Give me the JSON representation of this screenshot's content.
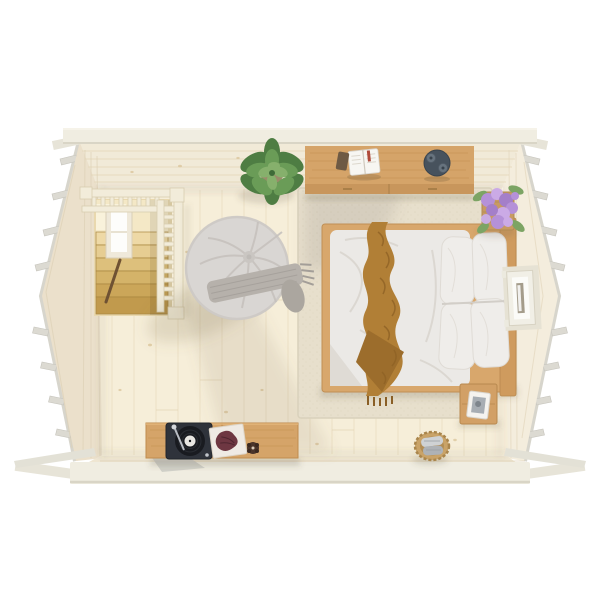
{
  "scene": {
    "title": "Top-down 3D render of a log cabin bedroom interior"
  },
  "labels": {
    "building": "Log cabin shell with protruding corner log ends",
    "floor": "Pale wooden plank floor",
    "stairwell": "Staircase opening with wooden railing",
    "stairWindow": "Stairwell window on left wall",
    "handrail": "Dark stair handrail",
    "rug": "Cream textured area rug",
    "sideboard": "Wooden sideboard against top wall",
    "book": "Open book",
    "phone": "Smartphone",
    "tray": "Dark round tray with two cups",
    "plant": "Leafy green potted plant",
    "lilac": "Lilac flower bouquet in wooden planter",
    "bed": "Double bed with white duvet",
    "pillows": "Four white pillows",
    "throw": "Camel knitted throw across the bed",
    "beanbag": "Round grey bean bag with fringed throw",
    "mediaConsole": "Low wooden media console",
    "turntable": "Black record player with vinyl",
    "sleeve": "Record sleeve with artwork",
    "candle": "Small dark candle",
    "nightstand": "Wooden bedside table",
    "photoFrame": "White photo frame",
    "basket": "Woven basket with rolled towels",
    "window": "Window in right wall"
  },
  "colors": {
    "bg": "#ffffff",
    "beam": "#f0ede1",
    "beamEdge": "#d9d5c6",
    "logEnd": "#dcdad2",
    "wallTop": "#f1ead8",
    "wallLeft": "#ebe0cb",
    "wallRight": "#f4eddd",
    "wallBottom": "#efe6d2",
    "floor": "#f6eed9",
    "floorLine": "#e6d8ba",
    "rug": "#e7dfcc",
    "rugEdge": "#d9d1bb",
    "wood": "#d5a469",
    "woodFront": "#c8965c",
    "bedFrame": "#d8a76c",
    "headboard": "#cf9b5e",
    "duvet": "#ebe9e6",
    "duvetShade": "#dfdbd5",
    "pillow": "#efedea",
    "throw": "#b17f36",
    "throwDark": "#9c6d2c",
    "beanbag": "#d9d6d3",
    "beanbagTuft": "#cac6c2",
    "beanbagThrow": "#b6b1ab",
    "plantDark": "#4e7d43",
    "plantMid": "#6a9c57",
    "plantLight": "#86b06c",
    "lilac": "#b591d8",
    "lilacLight": "#cbaae6",
    "lilacDark": "#a47fc9",
    "leaf": "#7ca464",
    "planter": "#c89a62",
    "turntable": "#2f333b",
    "vinyl": "#191b20",
    "vinylLabel": "#e8e6e2",
    "sleeve": "#efeae4",
    "sleeveArt": "#6e3742",
    "tray": "#47525d",
    "cup": "#67737e",
    "candle": "#4a342a",
    "basket": "#c9a368",
    "towelA": "#cfd2d4",
    "towelB": "#aeb2b6",
    "nightstand": "#d2a066",
    "frameWhite": "#f5f3ef",
    "photo": "#a7adb3",
    "windowFrame": "#f1efe6",
    "windowGlass": "#fbfbf8",
    "windowSlit": "#a49c8b",
    "railing": "#f2ecda",
    "stairLanding": "#f4e8c6",
    "treads": [
      "#eed9a6",
      "#e6cd92",
      "#ddc07c",
      "#d4b369",
      "#cba659",
      "#c19a4d"
    ]
  }
}
